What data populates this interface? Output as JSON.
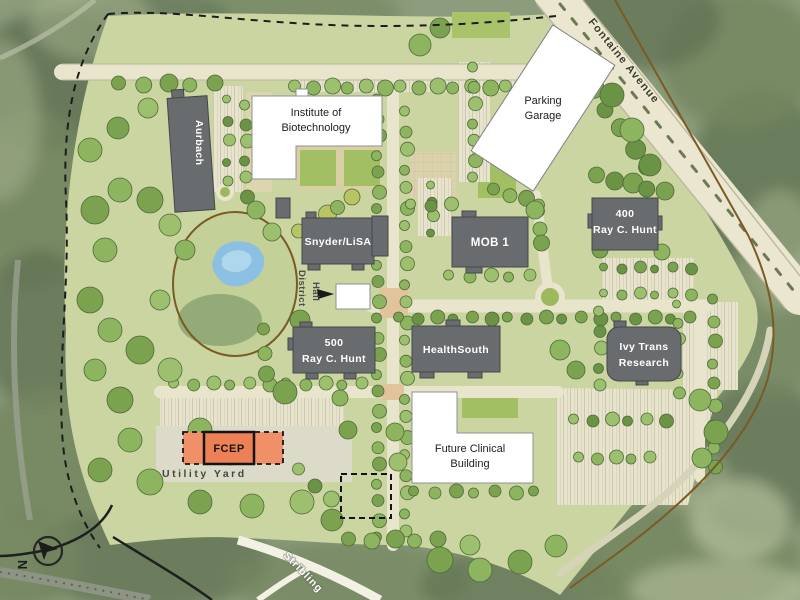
{
  "streets": {
    "fontaine": "Fontaine Avenue",
    "stribling": "Stribling"
  },
  "buildings": {
    "aurbach": {
      "label": "Aurbach"
    },
    "biotech": {
      "line1": "Institute of",
      "line2": "Biotechnology"
    },
    "garage": {
      "line1": "Parking",
      "line2": "Garage"
    },
    "snyder": {
      "label": "Snyder/LiSA"
    },
    "mob1": {
      "label": "MOB 1"
    },
    "rch400": {
      "line1": "400",
      "line2": "Ray C. Hunt"
    },
    "rch500": {
      "line1": "500",
      "line2": "Ray C. Hunt"
    },
    "healthsouth": {
      "label": "HealthSouth"
    },
    "ivy": {
      "line1": "Ivy Trans",
      "line2": "Research"
    },
    "future_clinical": {
      "line1": "Future Clinical",
      "line2": "Building"
    },
    "fcep": {
      "label": "FCEP"
    }
  },
  "areas": {
    "utility_yard": "Utility Yard",
    "district_hall_line1": "District",
    "district_hall_line2": "Hall"
  },
  "compass": {
    "north": "N"
  },
  "colors": {
    "campus_green": "#CBD5A2",
    "forest_green": "#73865F",
    "road_cream": "#EBE6CF",
    "building_gray": "#696C6F",
    "building_white": "#FFFFFF",
    "highlight_orange": "#EE8460",
    "pond_blue": "#8CC0E2",
    "trail_brown": "#7B5A24"
  }
}
